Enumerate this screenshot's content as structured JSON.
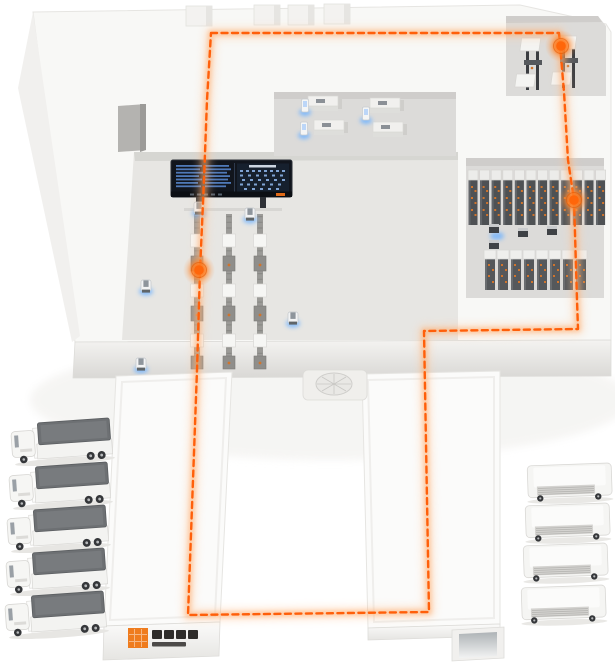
{
  "scene": {
    "title": "Isometric smart warehouse facility with dashed AGV route loop",
    "background": "#ffffff"
  },
  "palette": {
    "accent_orange": "#ff5f0a",
    "route_glow": "#ffa25c",
    "marker_orange": "#ff6a0d",
    "glow_blue": "#6fb2ff",
    "roof_white": "#f8f8f6",
    "floor_gray": "#e7e6e3",
    "recess_gray": "#dcdbd9",
    "rack_dark": "#4e5154",
    "truck_top_gray": "#6d7073",
    "screen_navy": "#11151d",
    "screen_text_blue": "#4f79b8"
  },
  "route": {
    "type": "closed-loop",
    "style": "dashed",
    "color": "#ff5f0a",
    "points": [
      [
        211,
        33
      ],
      [
        559,
        33
      ],
      [
        564,
        92
      ],
      [
        568,
        160
      ],
      [
        574,
        200
      ],
      [
        577,
        300
      ],
      [
        578,
        329
      ],
      [
        424,
        331
      ],
      [
        429,
        612
      ],
      [
        188,
        615
      ],
      [
        193,
        480
      ],
      [
        197,
        370
      ],
      [
        200,
        271
      ],
      [
        204,
        180
      ],
      [
        207,
        100
      ]
    ]
  },
  "markers": {
    "count": 3,
    "color": "#ff6a0d",
    "positions": [
      [
        561,
        46
      ],
      [
        574,
        200
      ],
      [
        199,
        270
      ]
    ]
  },
  "zones": [
    {
      "name": "inbound-machine-room",
      "contents": "2 conveyor machines, route marker"
    },
    {
      "name": "office-workstation-room",
      "contents": "4 desks, 3 glowing terminals"
    },
    {
      "name": "control-display-board",
      "contents": "large LED dashboard with blue data rows"
    },
    {
      "name": "sorting-conveyor-area",
      "contents": "3 vertical conveyor lines, AGV robots"
    },
    {
      "name": "storage-rack-room",
      "contents": "12 tall racks, 8 small racks, pallet cubes"
    },
    {
      "name": "shipping-hall-left",
      "contents": "company logo on facade, route passes through"
    },
    {
      "name": "shipping-hall-right",
      "contents": "dock ramp at front, route passes through"
    },
    {
      "name": "vent-platform",
      "contents": "circular rooftop fan between halls"
    }
  ],
  "vehicles": {
    "left_trucks": 5,
    "right_vans": 4
  },
  "robots": {
    "agv_count": 5,
    "glow_color": "#6fb2ff"
  },
  "logo": {
    "mark": "orange-pixel-square",
    "mark_color": "#ef7c1e",
    "wordmark": "dark CJK wordmark (illegible at render size)",
    "wordmark_color": "#2f2d2b"
  }
}
